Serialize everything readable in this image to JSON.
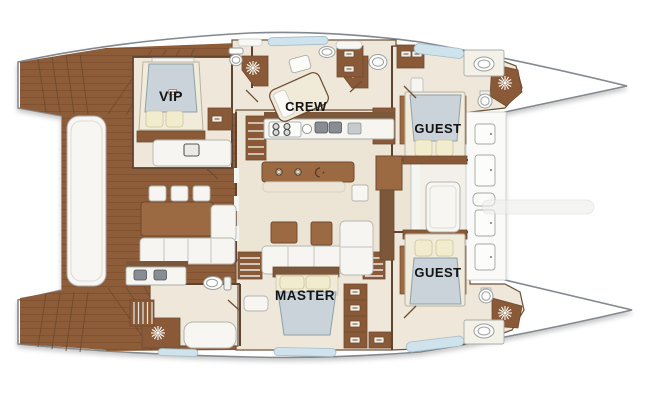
{
  "meta": {
    "title": "Catamaran yacht accommodation floor plan",
    "view": "top-down deck plan"
  },
  "rooms": {
    "vip": "VIP",
    "crew": "CREW",
    "guest_top": "GUEST",
    "guest_bottom": "GUEST",
    "master": "MASTER"
  },
  "features": {
    "cabin_count": 5,
    "icons": [
      "shower-sunburst-icon",
      "cooktop-burner-icon",
      "sink-icon",
      "toilet-icon",
      "stairs-icon",
      "deck-hatch-icon"
    ]
  },
  "colors": {
    "deck_wood": "#8d5c39",
    "wood_dark": "#7c573a",
    "furniture_wood": "#9b6a43",
    "interior_floor": "#ece5d6",
    "cabin_floor": "#efe8da",
    "mattress_blue": "#c9d3d9",
    "pillow_cream": "#f2eccf",
    "window_glass": "#cfe3ec",
    "hull_outline": "#82888d",
    "label_text": "#141414"
  }
}
